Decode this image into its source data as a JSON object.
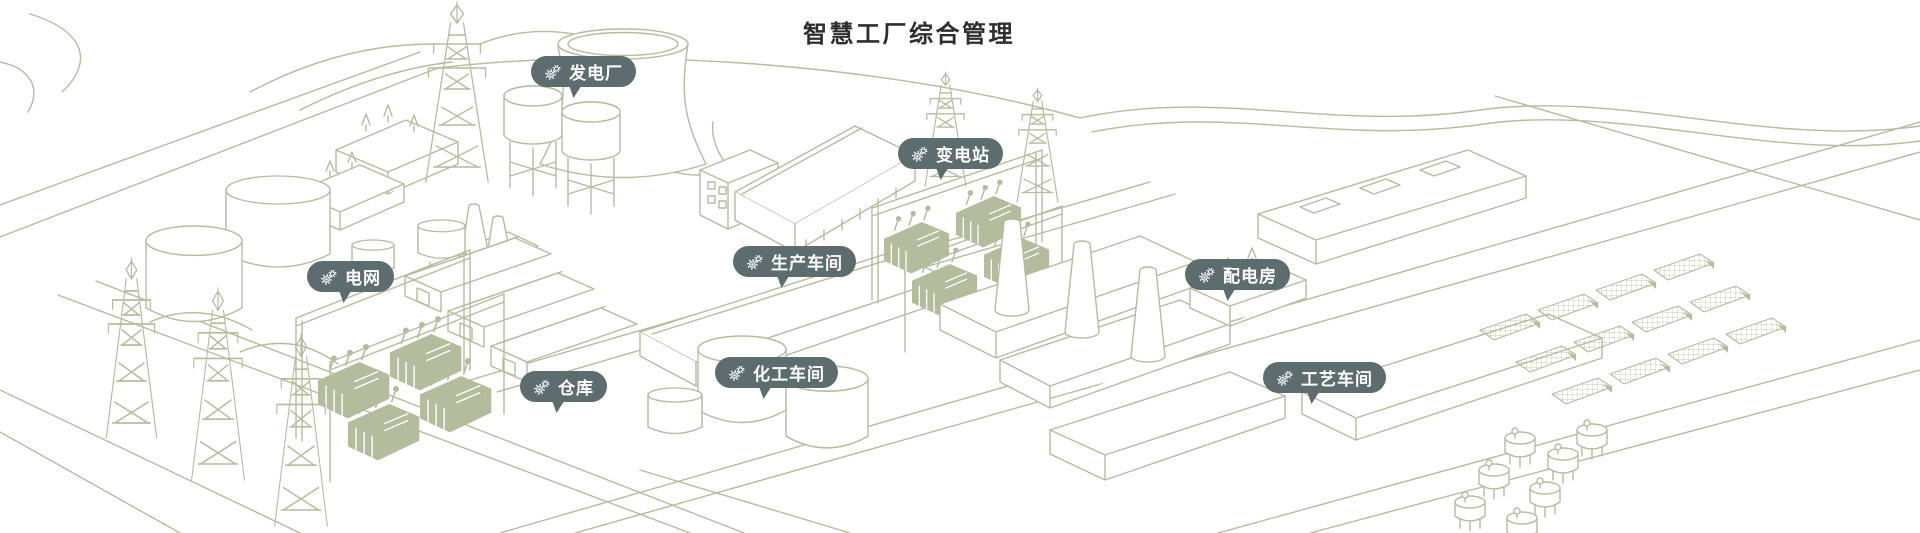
{
  "title": "智慧工厂综合管理",
  "colors": {
    "canvas": "#ffffff",
    "line_art": "#b4bc9e",
    "pill_background": "#5d6c6f",
    "pill_text": "#ffffff",
    "title_text": "#2e2e2e"
  },
  "pins": {
    "items": [
      {
        "id": "power-plant",
        "label": "发电厂",
        "icon": "gears-icon"
      },
      {
        "id": "substation",
        "label": "变电站",
        "icon": "gears-icon"
      },
      {
        "id": "power-grid",
        "label": "电网",
        "icon": "gears-icon"
      },
      {
        "id": "production-workshop",
        "label": "生产车间",
        "icon": "gears-icon"
      },
      {
        "id": "distribution-room",
        "label": "配电房",
        "icon": "gears-icon"
      },
      {
        "id": "warehouse",
        "label": "仓库",
        "icon": "gears-icon"
      },
      {
        "id": "chemical-workshop",
        "label": "化工车间",
        "icon": "gears-icon"
      },
      {
        "id": "process-workshop",
        "label": "工艺车间",
        "icon": "gears-icon"
      }
    ]
  }
}
